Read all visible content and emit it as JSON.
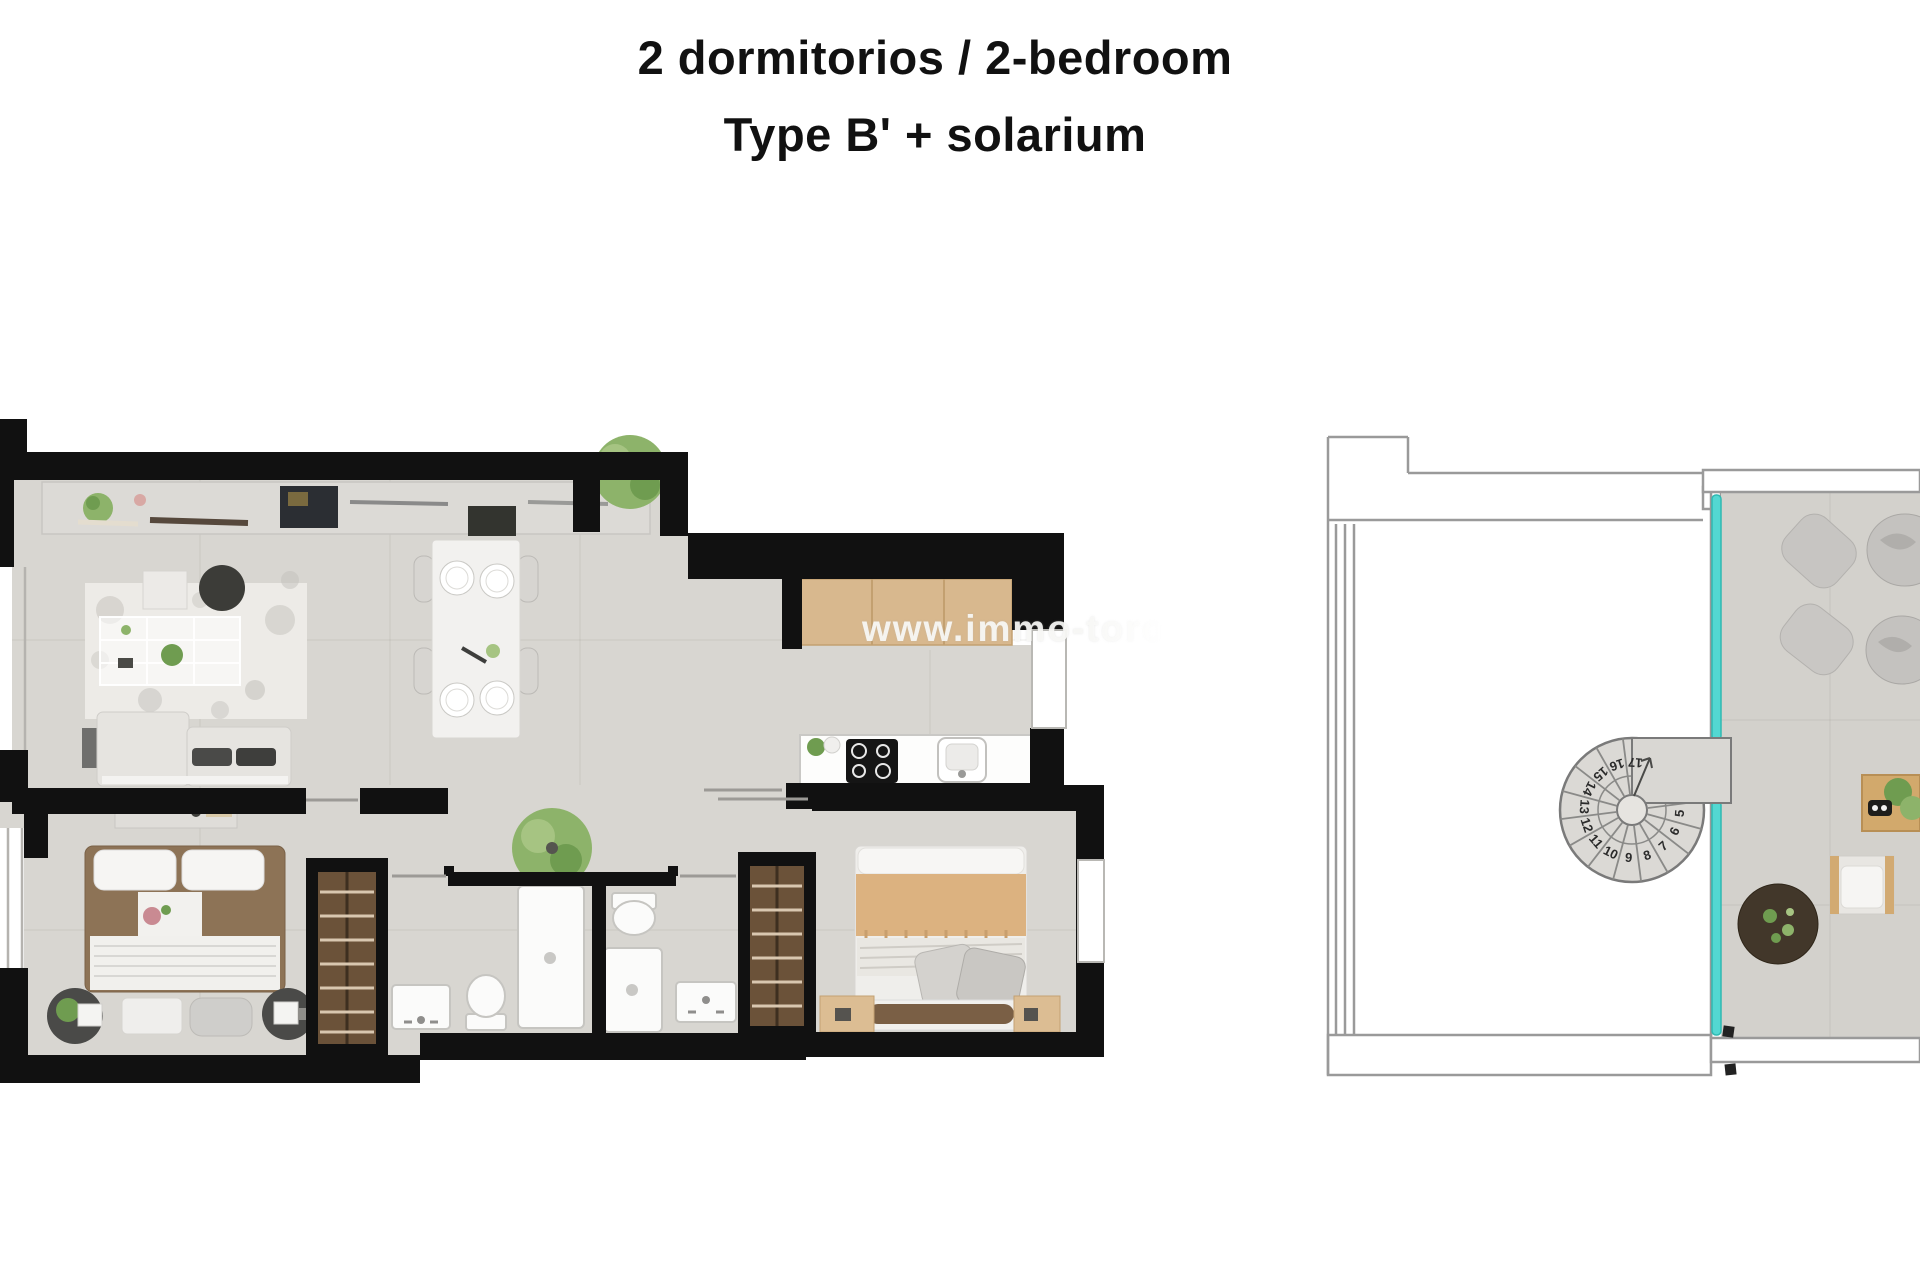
{
  "title": {
    "line1": "2 dormitorios / 2-bedroom",
    "line2": "Type B' + solarium"
  },
  "watermark": {
    "text": "www.immo-toro"
  },
  "apartment": {
    "label": "2-bedroom apartment floor plan"
  },
  "solarium": {
    "label": "Solarium / roof terrace plan",
    "staircase": {
      "steps": [
        "5",
        "6",
        "7",
        "8",
        "9",
        "10",
        "11",
        "12",
        "13",
        "14",
        "15",
        "16",
        "17"
      ]
    }
  },
  "colors": {
    "wall": "#111111",
    "floor": "#d8d6d1",
    "terrace_floor": "#d3d1cc",
    "glass": "#53d8d2",
    "wood_counter": "#d8b88e",
    "wardrobe": "#6b5239",
    "rug": "#edebe7",
    "outline": "#9a9a9a",
    "title_text": "#111111",
    "watermark_text": "#f5f5f3"
  }
}
